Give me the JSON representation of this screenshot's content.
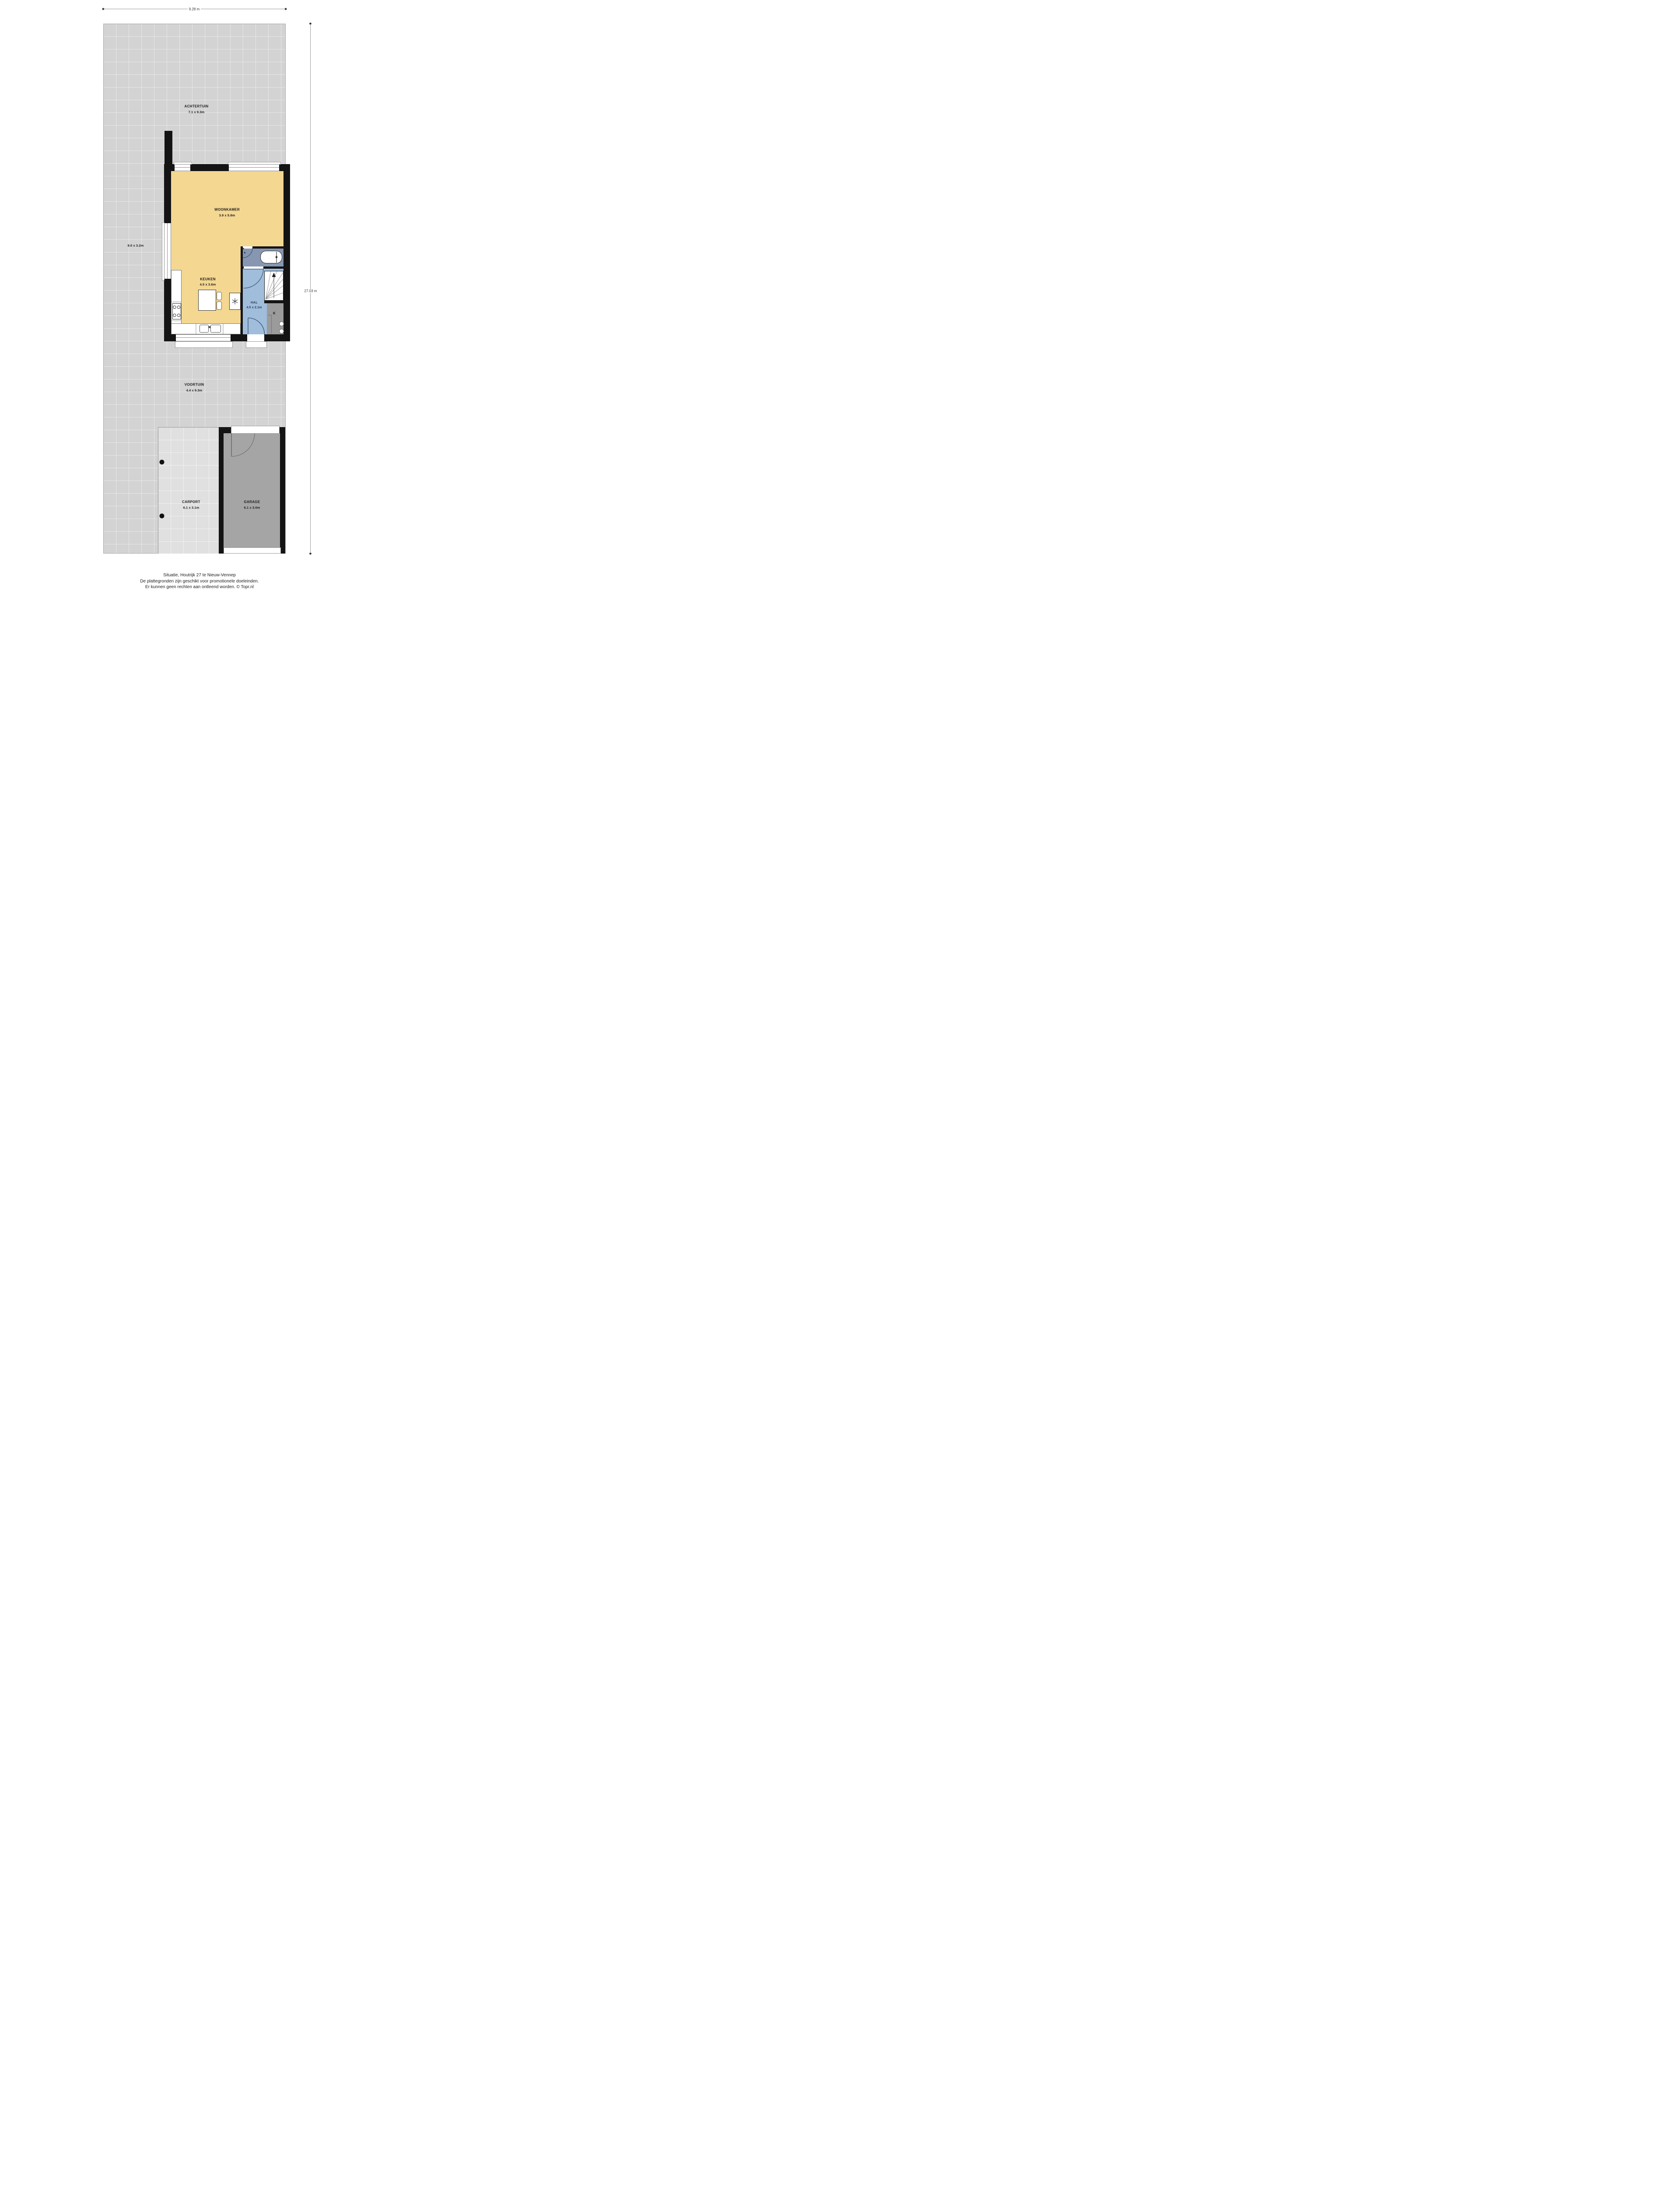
{
  "dimensions": {
    "width": "9.28 m",
    "height": "27.03 m"
  },
  "rooms": {
    "achtertuin": {
      "name": "ACHTERTUIN",
      "size": "7.1 x 9.3m"
    },
    "zijtuin": {
      "size": "9.0 x 3.2m"
    },
    "woonkamer": {
      "name": "WOONKAMER",
      "size": "3.9 x 5.8m"
    },
    "keuken": {
      "name": "KEUKEN",
      "size": "4.5 x 3.6m"
    },
    "hal": {
      "name": "HAL",
      "size": "4.5 x 2.1m"
    },
    "kast": {
      "name": "K"
    },
    "voortuin": {
      "name": "VOORTUIN",
      "size": "4.4 x 9.3m"
    },
    "carport": {
      "name": "CARPORT",
      "size": "6.1 x 3.1m"
    },
    "garage": {
      "name": "GARAGE",
      "size": "6.1 x 3.0m"
    }
  },
  "footer": {
    "line1": "Situatie, Houtrijk 27 te Nieuw-Vennep",
    "line2": "De plattegronden zijn geschikt voor promotionele doeleinden.",
    "line3": "Er kunnen geen rechten aan ontleend worden. © Topr.nl"
  },
  "colors": {
    "garden": "#d3d3d3",
    "carport": "#e0e0e0",
    "garage_floor": "#a5a5a5",
    "living": "#f4d791",
    "hall": "#a0bddb",
    "bathroom": "#8797b2",
    "closet": "#9b9b9b",
    "wall": "#141414",
    "arc": "#3d5878"
  }
}
